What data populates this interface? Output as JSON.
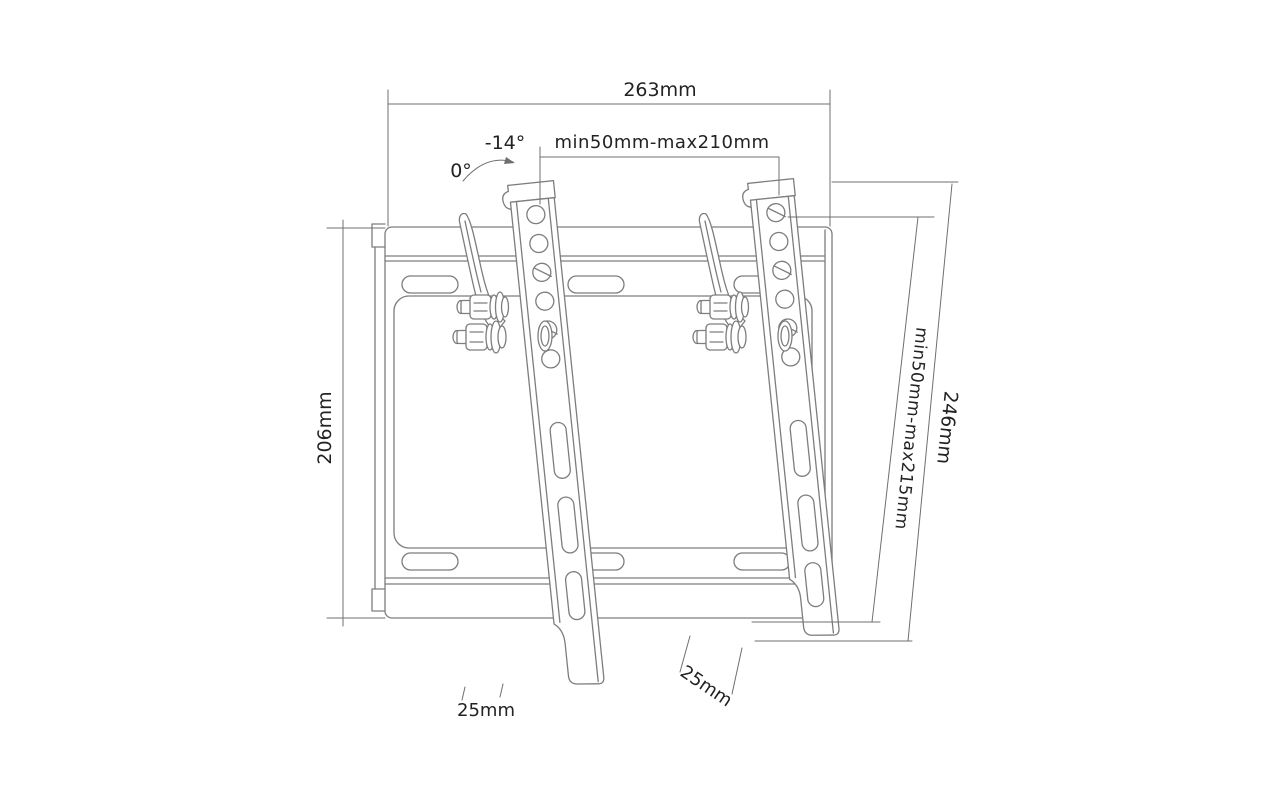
{
  "annotations": {
    "width_total": "263mm",
    "tilt_angle_max": "-14°",
    "tilt_angle_zero": "0°",
    "vesa_width_range": "min50mm-max210mm",
    "height_total": "206mm",
    "vesa_height_range": "min50mm-max215mm",
    "bracket_length": "246mm",
    "left_tab_width": "25mm",
    "right_tab_width": "25mm"
  },
  "colors": {
    "background": "#ffffff",
    "part_line": "#7d7d7d",
    "dimension_line": "#6f6f6f",
    "label_text": "#222222"
  }
}
